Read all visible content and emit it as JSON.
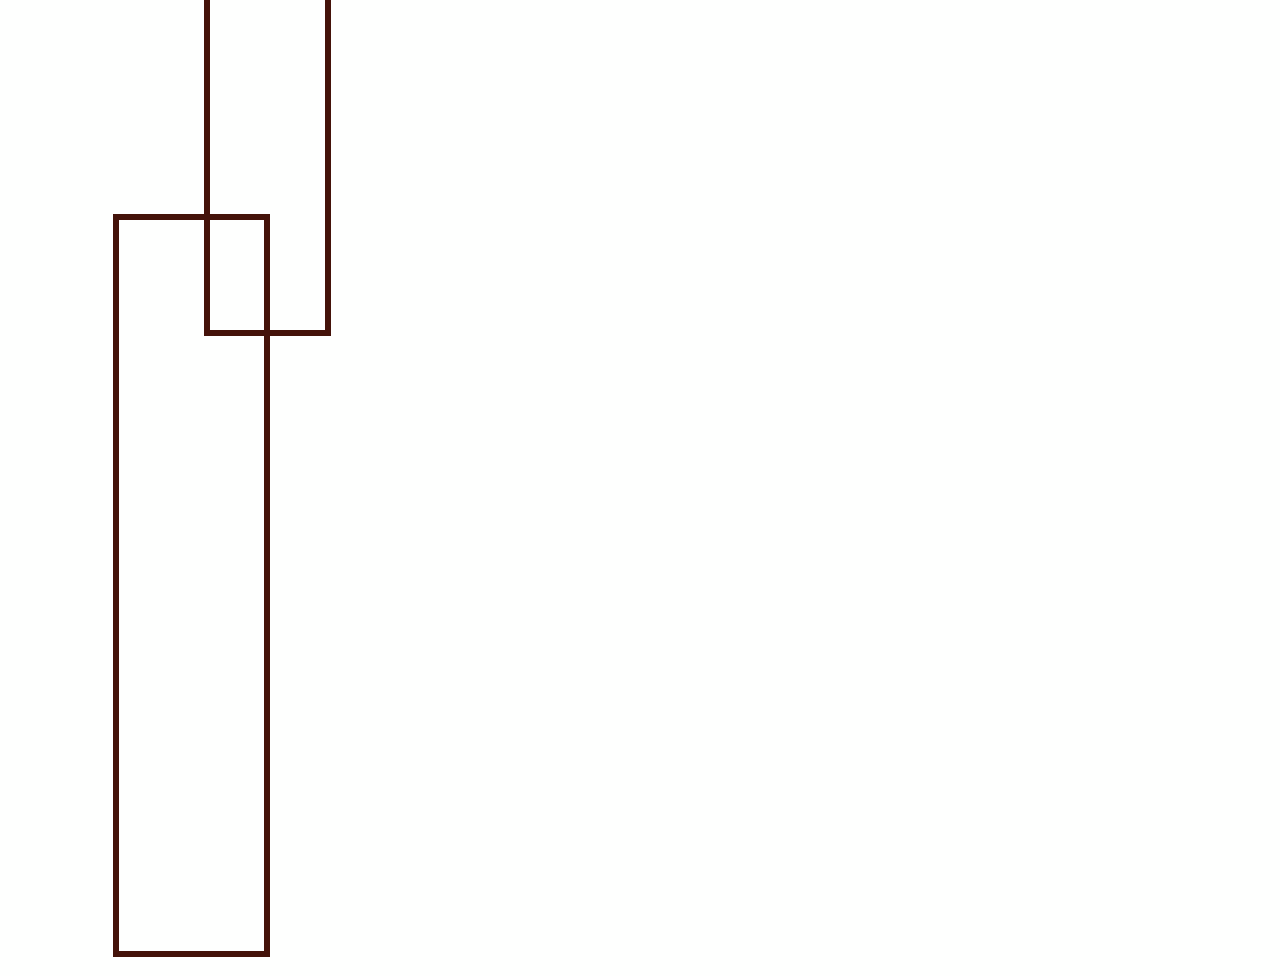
{
  "canvas": {
    "width": 1280,
    "height": 976,
    "background_color": "#fefffe"
  },
  "shapes": [
    {
      "name": "outlined-rectangle-top",
      "type": "rectangle",
      "x": 204,
      "y": -24,
      "width": 127,
      "height": 360,
      "stroke_color": "#44130a",
      "stroke_width": 6,
      "fill": "transparent",
      "note": "top edge extends above the visible viewport"
    },
    {
      "name": "outlined-rectangle-left",
      "type": "rectangle",
      "x": 113,
      "y": 214,
      "width": 157,
      "height": 743,
      "stroke_color": "#44130a",
      "stroke_width": 6,
      "fill": "transparent",
      "note": "overlaps the top rectangle around its lower-left region"
    }
  ]
}
